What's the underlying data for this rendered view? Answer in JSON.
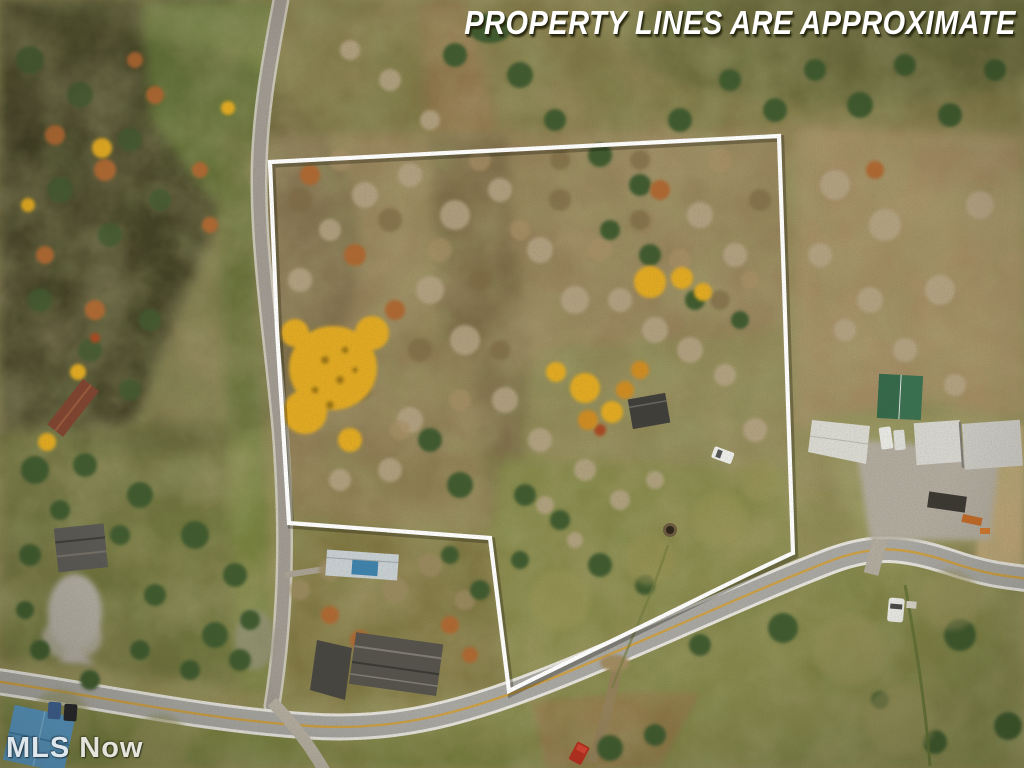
{
  "image": {
    "type": "aerial-drone-photo",
    "subject": "autumn wooded rural property for sale with approximate boundary lines drawn in white"
  },
  "overlay": {
    "disclaimer_text": "PROPERTY LINES ARE APPROXIMATE",
    "watermark_text": "MLS Now"
  },
  "colors": {
    "boundary_line": "#ffffff",
    "disclaimer_text": "#ffffff",
    "watermark_text": "#ffffff",
    "road_asphalt": "#a8a7a2",
    "road_centerline_yellow": "#cf9f3a",
    "autumn_gold_tree": "#e2aa20",
    "barn_roof_green": "#3a7050"
  },
  "scene": {
    "landmarks": [
      "white-boundary-polygon-with-notch",
      "country-road-running-north-south-along-west-boundary",
      "main-paved-road-s-curve-along-south-boundary",
      "golden-maple-tree-cluster",
      "dark-cabin-inside-property",
      "white-car-inside-property",
      "fire-pit-circle-in-meadow",
      "farm-compound-green-roof-barn-and-white-sheds",
      "gravel-farm-driveway",
      "mobile-home-with-blue-tarp-in-notch",
      "collapsed-dark-roof-barn-in-notch",
      "red-roof-shed-west-of-road",
      "gray-collapsed-shed-west-of-road",
      "gravel-pad-west-of-road",
      "blue-roof-house-bottom-left",
      "parked-cars-bottom-left",
      "white-car-in-east-field",
      "red-truck-near-bottom-edge",
      "tan-dirt-field-east-edge"
    ]
  }
}
